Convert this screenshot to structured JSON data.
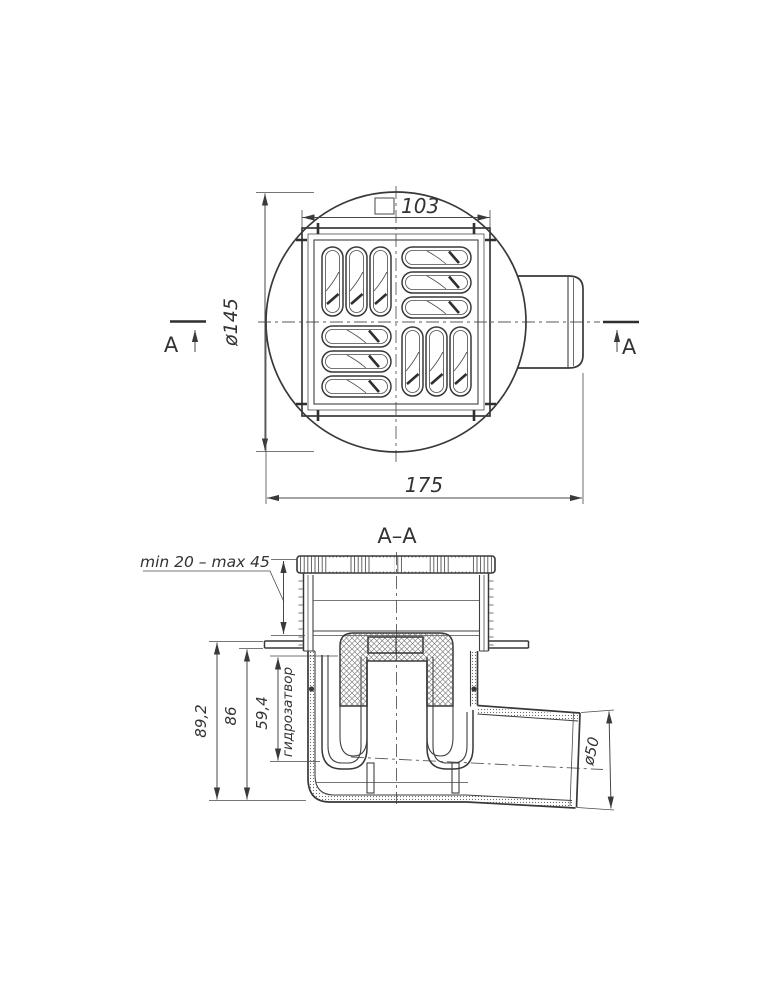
{
  "drawing": {
    "background": "#ffffff",
    "ink_color": "#383838",
    "top_view": {
      "section_letter_left": "A",
      "section_letter_right": "A",
      "grate_size": "103",
      "flange_diameter": "ø145",
      "overall_width": "175"
    },
    "section_view": {
      "title": "A–A",
      "mounting_range": "min 20 – max 45",
      "overall_height": "89,2",
      "body_height": "86",
      "water_seal_height": "59,4",
      "water_seal_name": "гидрозатвор",
      "outlet_diameter": "ø50"
    }
  }
}
